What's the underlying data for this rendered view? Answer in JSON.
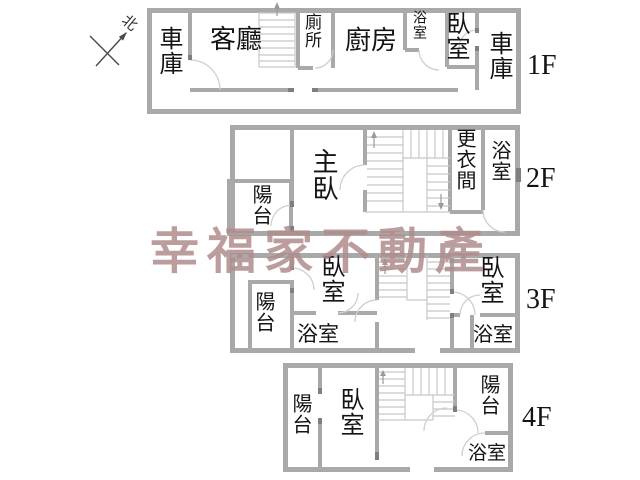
{
  "watermark": {
    "text": "幸福家不動產",
    "color": "#b08c8c"
  },
  "north_label": "北",
  "colors": {
    "wall": "#a9a9a9",
    "wall_dark": "#7f7f7f",
    "stair": "#c8c8c8",
    "text": "#141414"
  },
  "floors": {
    "f1": {
      "label": "1F",
      "rooms": {
        "garage_left": "車庫",
        "living_room": "客廳",
        "toilet": "廁所",
        "kitchen": "廚房",
        "bathroom": "浴室",
        "bedroom": "臥室",
        "garage_right": "車庫"
      }
    },
    "f2": {
      "label": "2F",
      "rooms": {
        "balcony": "陽台",
        "master_bedroom": "主臥",
        "dressing_room": "更衣間",
        "bathroom": "浴室"
      }
    },
    "f3": {
      "label": "3F",
      "rooms": {
        "balcony": "陽台",
        "bedroom_left": "臥室",
        "bathroom_left": "浴室",
        "bedroom_right": "臥室",
        "bathroom_right": "浴室"
      }
    },
    "f4": {
      "label": "4F",
      "rooms": {
        "balcony_left": "陽台",
        "bedroom": "臥室",
        "balcony_right": "陽台",
        "bathroom": "浴室"
      }
    }
  }
}
